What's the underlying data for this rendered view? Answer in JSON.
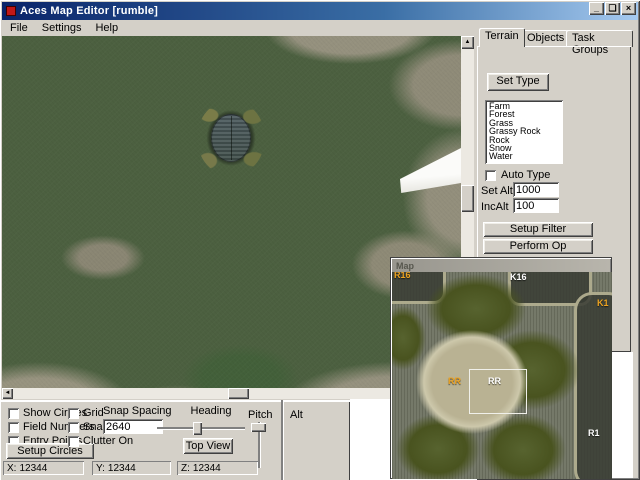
{
  "window": {
    "title": "Aces Map Editor [rumble]",
    "controls": {
      "minimize": "_",
      "maximize": "❏",
      "close": "×"
    }
  },
  "menu": {
    "items": [
      "File",
      "Settings",
      "Help"
    ]
  },
  "right_panel": {
    "tabs": [
      "Terrain",
      "Objects",
      "Task Groups"
    ],
    "active_tab": "Terrain",
    "set_type_label": "Set Type",
    "terrain_types": [
      "Farm",
      "Forest",
      "Grass",
      "Grassy Rock",
      "Rock",
      "Snow",
      "Water"
    ],
    "auto_type_label": "Auto Type",
    "set_alt_label": "Set Alt",
    "set_alt_value": "1000",
    "inc_alt_label": "IncAlt",
    "inc_alt_value": "100",
    "setup_filter_label": "Setup Filter",
    "perform_op_label": "Perform Op",
    "show_transitions_label": "Show Transitions",
    "water_not_label": "Water Not 0"
  },
  "bottom_panel": {
    "show_circles_label": "Show Circles",
    "field_numbers_label": "Field Numbers",
    "entry_points_label": "Entry Points",
    "setup_circles_label": "Setup Circles",
    "grid_label": "Grid",
    "snap_label": "Snap",
    "clutter_on_label": "Clutter On",
    "snap_spacing_label": "Snap Spacing",
    "snap_spacing_value": "2640",
    "heading_label": "Heading",
    "top_view_label": "Top View",
    "pitch_label": "Pitch",
    "alt_label": "Alt",
    "coords": [
      {
        "axis": "X:",
        "value": "12344"
      },
      {
        "axis": "Y:",
        "value": "12344"
      },
      {
        "axis": "Z:",
        "value": "12344"
      }
    ]
  },
  "scrollbars": {
    "up": "▲",
    "down": "▼",
    "left": "◄",
    "right": "►"
  },
  "map_window": {
    "title": "Map",
    "labels": [
      {
        "text": "R16",
        "color": "#eda321"
      },
      {
        "text": "K16",
        "color": "#ffffff"
      },
      {
        "text": "K1",
        "color": "#eda321"
      },
      {
        "text": "RR",
        "color": "#eda321"
      },
      {
        "text": "RR",
        "color": "#ffffff"
      },
      {
        "text": "R1",
        "color": "#ffffff"
      }
    ]
  },
  "colors": {
    "titlebar_start": "#0a246a",
    "titlebar_end": "#a6caf0",
    "chrome": "#d4d0c8",
    "terrain_green": "#4c6040",
    "terrain_rock": "#95917e",
    "map_orange_label": "#eda321"
  }
}
